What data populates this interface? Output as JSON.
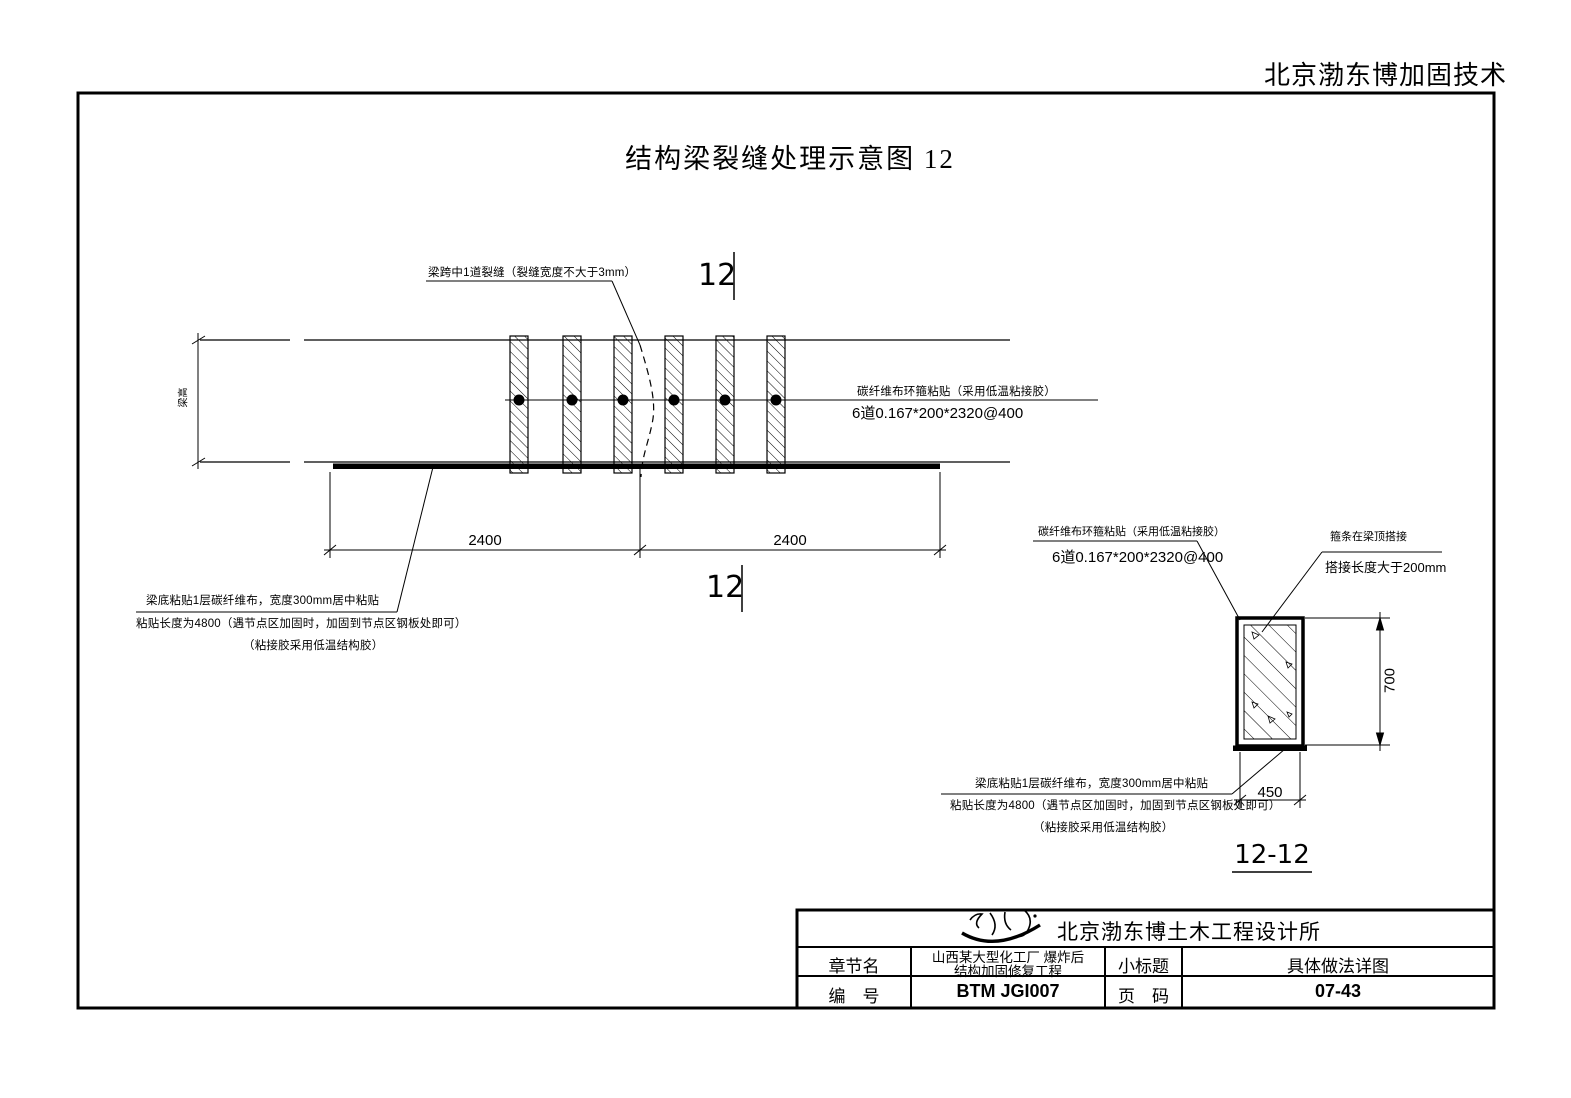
{
  "page": {
    "watermark": "北京渤东博加固技术",
    "title": "结构梁裂缝处理示意图  12"
  },
  "elevation": {
    "beam_height_label": "梁高",
    "crack_note": "梁跨中1道裂缝（裂缝宽度不大于3mm）",
    "hoop_note_line1": "碳纤维布环箍粘贴（采用低温粘接胶）",
    "hoop_note_line2": "6道0.167*200*2320@400",
    "bottom_note_line1": "梁底粘贴1层碳纤维布，宽度300mm居中粘贴",
    "bottom_note_line2": "粘贴长度为4800（遇节点区加固时，加固到节点区钢板处即可）",
    "bottom_note_line3": "（粘接胶采用低温结构胶）",
    "dim_left": "2400",
    "dim_right": "2400",
    "section_marker_top": "12",
    "section_marker_bottom": "12"
  },
  "section": {
    "label": "12-12",
    "hoop_note_line1": "碳纤维布环箍粘贴（采用低温粘接胶）",
    "hoop_note_line2": "6道0.167*200*2320@400",
    "lap_note_line1": "箍条在梁顶搭接",
    "lap_note_line2": "搭接长度大于200mm",
    "bottom_note_line1": "梁底粘贴1层碳纤维布，宽度300mm居中粘贴",
    "bottom_note_line2": "粘贴长度为4800（遇节点区加固时，加固到节点区钢板处即可）",
    "bottom_note_line3": "（粘接胶采用低温结构胶）",
    "dim_height": "700",
    "dim_width": "450"
  },
  "titleblock": {
    "company": "北京渤东博土木工程设计所",
    "chapter_label": "章节名",
    "project_line1": "山西某大型化工厂 爆炸后",
    "project_line2": "结构加固修复工程",
    "subtitle_label": "小标题",
    "subtitle_value": "具体做法详图",
    "number_label": "编　号",
    "number_value": "BTM JGI007",
    "page_label": "页　码",
    "page_value": "07-43"
  },
  "colors": {
    "ink": "#000000",
    "paper": "#ffffff"
  }
}
